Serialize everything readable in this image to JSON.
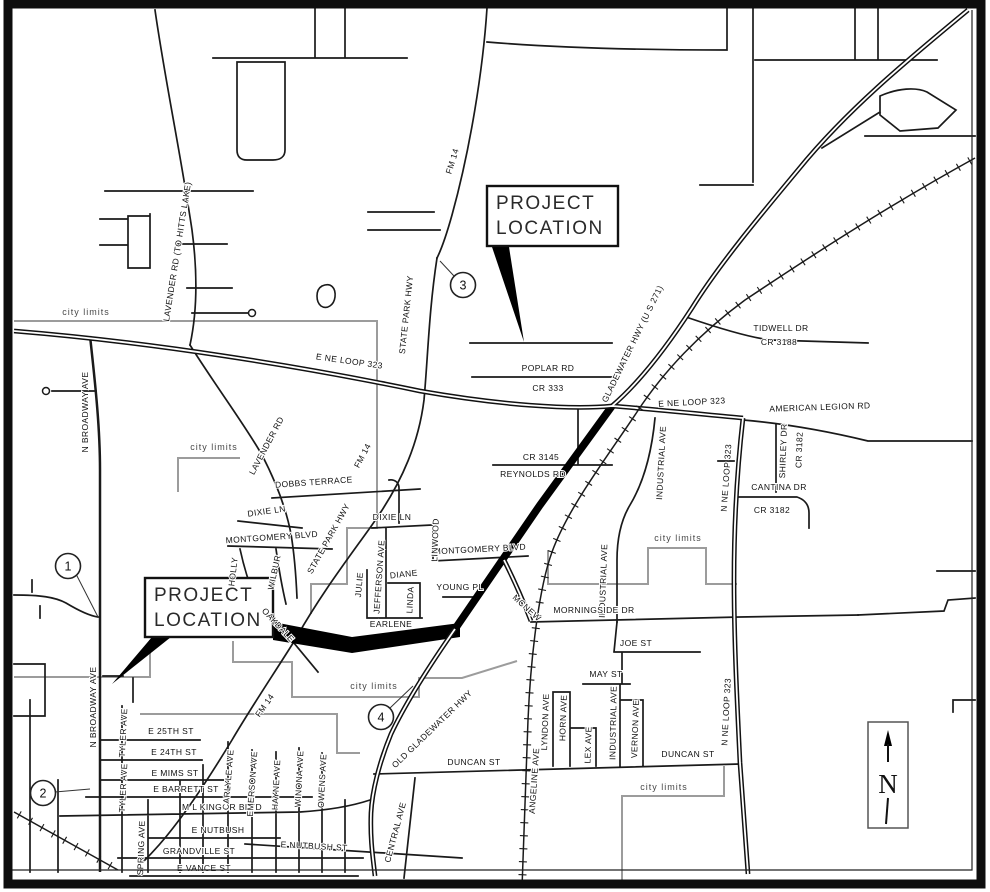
{
  "map": {
    "callout": {
      "line1": "PROJECT",
      "line2": "LOCATION"
    },
    "north": {
      "letter": "N"
    },
    "markers": {
      "m1": "1",
      "m2": "2",
      "m3": "3",
      "m4": "4"
    },
    "colors": {
      "background": "#ffffff",
      "road_ink": "#1a1a1a",
      "city_limits_line": "#9c9c9c",
      "callout_fill": "#ffffff",
      "callout_stroke": "#111111"
    },
    "labels": {
      "city_limits": "city limits",
      "broadway": "N BROADWAY AVE",
      "lavender_hitts": "LAVENDER RD (TO HITTS LAKE)",
      "lavender": "LAVENDER RD",
      "loop323_e": "E NE LOOP 323",
      "loop323_n": "N NE LOOP 323",
      "state_park": "STATE PARK HWY",
      "fm14": "FM 14",
      "gladewater": "GLADEWATER HWY (U S 271)",
      "old_gladewater": "OLD GLADEWATER HWY",
      "poplar": "POPLAR RD",
      "cr333": "CR 333",
      "tidwell": "TIDWELL DR",
      "cr3188": "CR 3188",
      "american_legion": "AMERICAN LEGION RD",
      "industrial": "INDUSTRIAL AVE",
      "shirley": "SHIRLEY DR",
      "cr3182": "CR 3182",
      "cantina": "CANTINA DR",
      "cr3145": "CR 3145",
      "reynolds": "REYNOLDS RD",
      "dobbs": "DOBBS TERRACE",
      "dixie": "DIXIE LN",
      "montgomery": "MONTGOMERY BLVD",
      "linwood": "LINWOOD",
      "julie": "JULIE",
      "jefferson": "JEFFERSON AVE",
      "diane": "DIANE",
      "linda": "LINDA",
      "earlene": "EARLENE",
      "young": "YOUNG PL",
      "mcnew": "MCNEW",
      "morningside": "MORNINGSIDE DR",
      "joe": "JOE ST",
      "may": "MAY ST",
      "lyndon": "LYNDON AVE",
      "horn": "HORN AVE",
      "lex": "LEX AVE",
      "vernon": "VERNON AVE",
      "duncan": "DUNCAN ST",
      "angeline": "ANGELINE AVE",
      "central": "CENTRAL AVE",
      "holly": "HOLLY",
      "wilbur": "WILBUR",
      "oakdale": "OAKDALE",
      "e25": "E 25TH ST",
      "e24": "E 24TH ST",
      "mims": "E MIMS ST",
      "barrett": "E BARRETT ST",
      "mlk": "M L KING JR BLVD",
      "nutbush": "E NUTBUSH",
      "nutbush_st": "E NUTBUSH ST",
      "grandville": "GRANDVILLE ST",
      "vance": "E VANCE ST",
      "spring": "SPRING AVE",
      "tyler": "TYLER AVE",
      "carlyle": "CARLYLE AVE",
      "emerson": "EMERSON AVE",
      "hayne": "HAYNE AVE",
      "winona": "WINONA AVE",
      "owens": "OWENS AVE"
    }
  }
}
